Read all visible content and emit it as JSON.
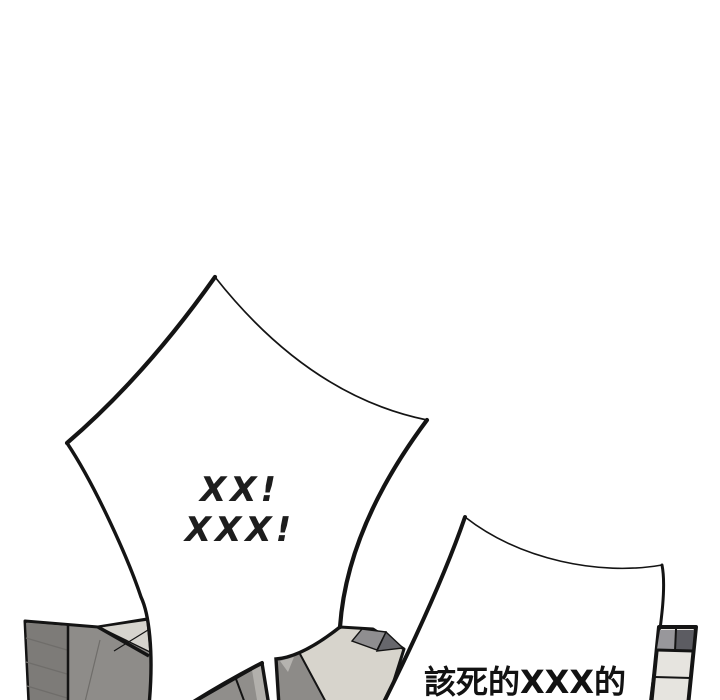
{
  "comic": {
    "panel_type": "webtoon comic panel segment",
    "background_color": "#ffffff",
    "ink_color": "#141414",
    "bubbles": {
      "shout": {
        "style": "spiky burst speech bubble",
        "lines": [
          "XX!",
          "XXX!"
        ]
      },
      "curse": {
        "style": "spiky burst speech bubble",
        "text": "該死的XXX的"
      }
    },
    "artwork": {
      "left_wall": "gray tiled wall fragment, bottom-left corner",
      "center_debris": "broken wall fragments between the speech bubbles",
      "right_window": "tilted window frame fragment, bottom-right corner"
    },
    "colors": {
      "wall_gray": "#8e8c89",
      "wall_gray_dark": "#7d7b78",
      "wall_highlight": "#d6d4ce",
      "debris_beige": "#d7d4cc",
      "debris_gray": "#8d8b88",
      "debris_dark": "#67676c",
      "pane_light": "#e6e4df",
      "pane_gray": "#98979b",
      "pane_dark": "#5c5c62"
    }
  }
}
